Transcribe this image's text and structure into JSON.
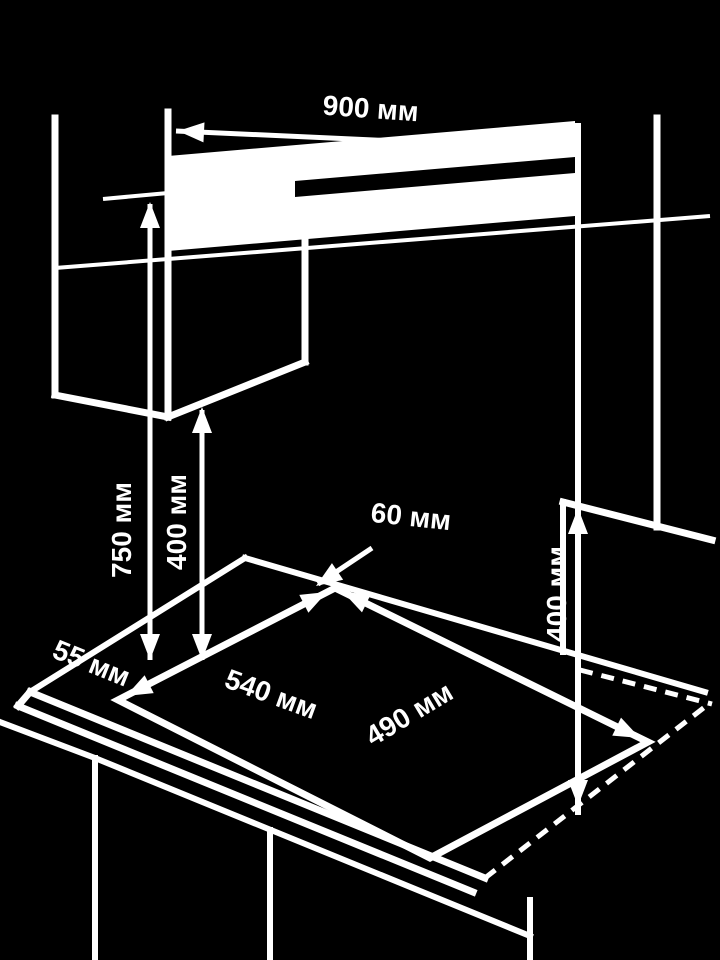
{
  "title": "Built-in hob installation clearances diagram",
  "colors": {
    "background": "#000000",
    "lines": "#ffffff",
    "text": "#ffffff"
  },
  "unit": "мм",
  "labels": {
    "hood_width": "900 мм",
    "hood_clearance": "750 мм",
    "cabinet_clearance_left": "400 мм",
    "cabinet_clearance_right": "400 мм",
    "rear_gap": "60 мм",
    "side_gap": "55 мм",
    "cutout_width": "540 мм",
    "cutout_depth": "490 мм"
  }
}
